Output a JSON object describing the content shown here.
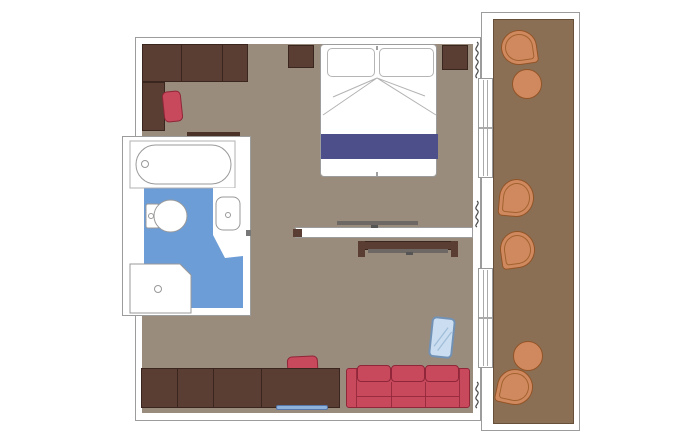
{
  "colors": {
    "floor": "#9A8C7C",
    "balcony_floor": "#8A6F55",
    "balcony_edge": "#66503A",
    "wood_dark": "#5A3D33",
    "wood_border": "#3A261F",
    "red": "#C8485C",
    "red_border": "#8F2639",
    "navy": "#4C4F8A",
    "terracotta": "#D0895E",
    "terracotta_border": "#925426",
    "bath_blue": "#6D9DD6",
    "mat_blue": "#8FB2DC",
    "mirror_blue": "#CBDDF0",
    "mirror_border": "#7292B5",
    "wall_line": "#9C9C9C",
    "fixture_line": "#999999",
    "tv_gray": "#6E6864",
    "curtain": "#4A4A4A"
  },
  "floorplan": {
    "areas": [
      "bathroom",
      "bedroom-living-cabin",
      "balcony"
    ],
    "furniture_icons": [
      "wardrobe",
      "vanity-desk",
      "desk-chair",
      "wall-shelf",
      "nightstand-left",
      "nightstand-right",
      "double-bed",
      "pillow",
      "bed-runner",
      "partition-wall",
      "tv-bedroom",
      "tv-desk-unit",
      "standing-mirror",
      "sofa",
      "sideboard-desk",
      "doormat",
      "bathtub",
      "toilet",
      "sink-counter",
      "shower",
      "sliding-door",
      "curtain",
      "balcony-chair",
      "balcony-table"
    ]
  }
}
